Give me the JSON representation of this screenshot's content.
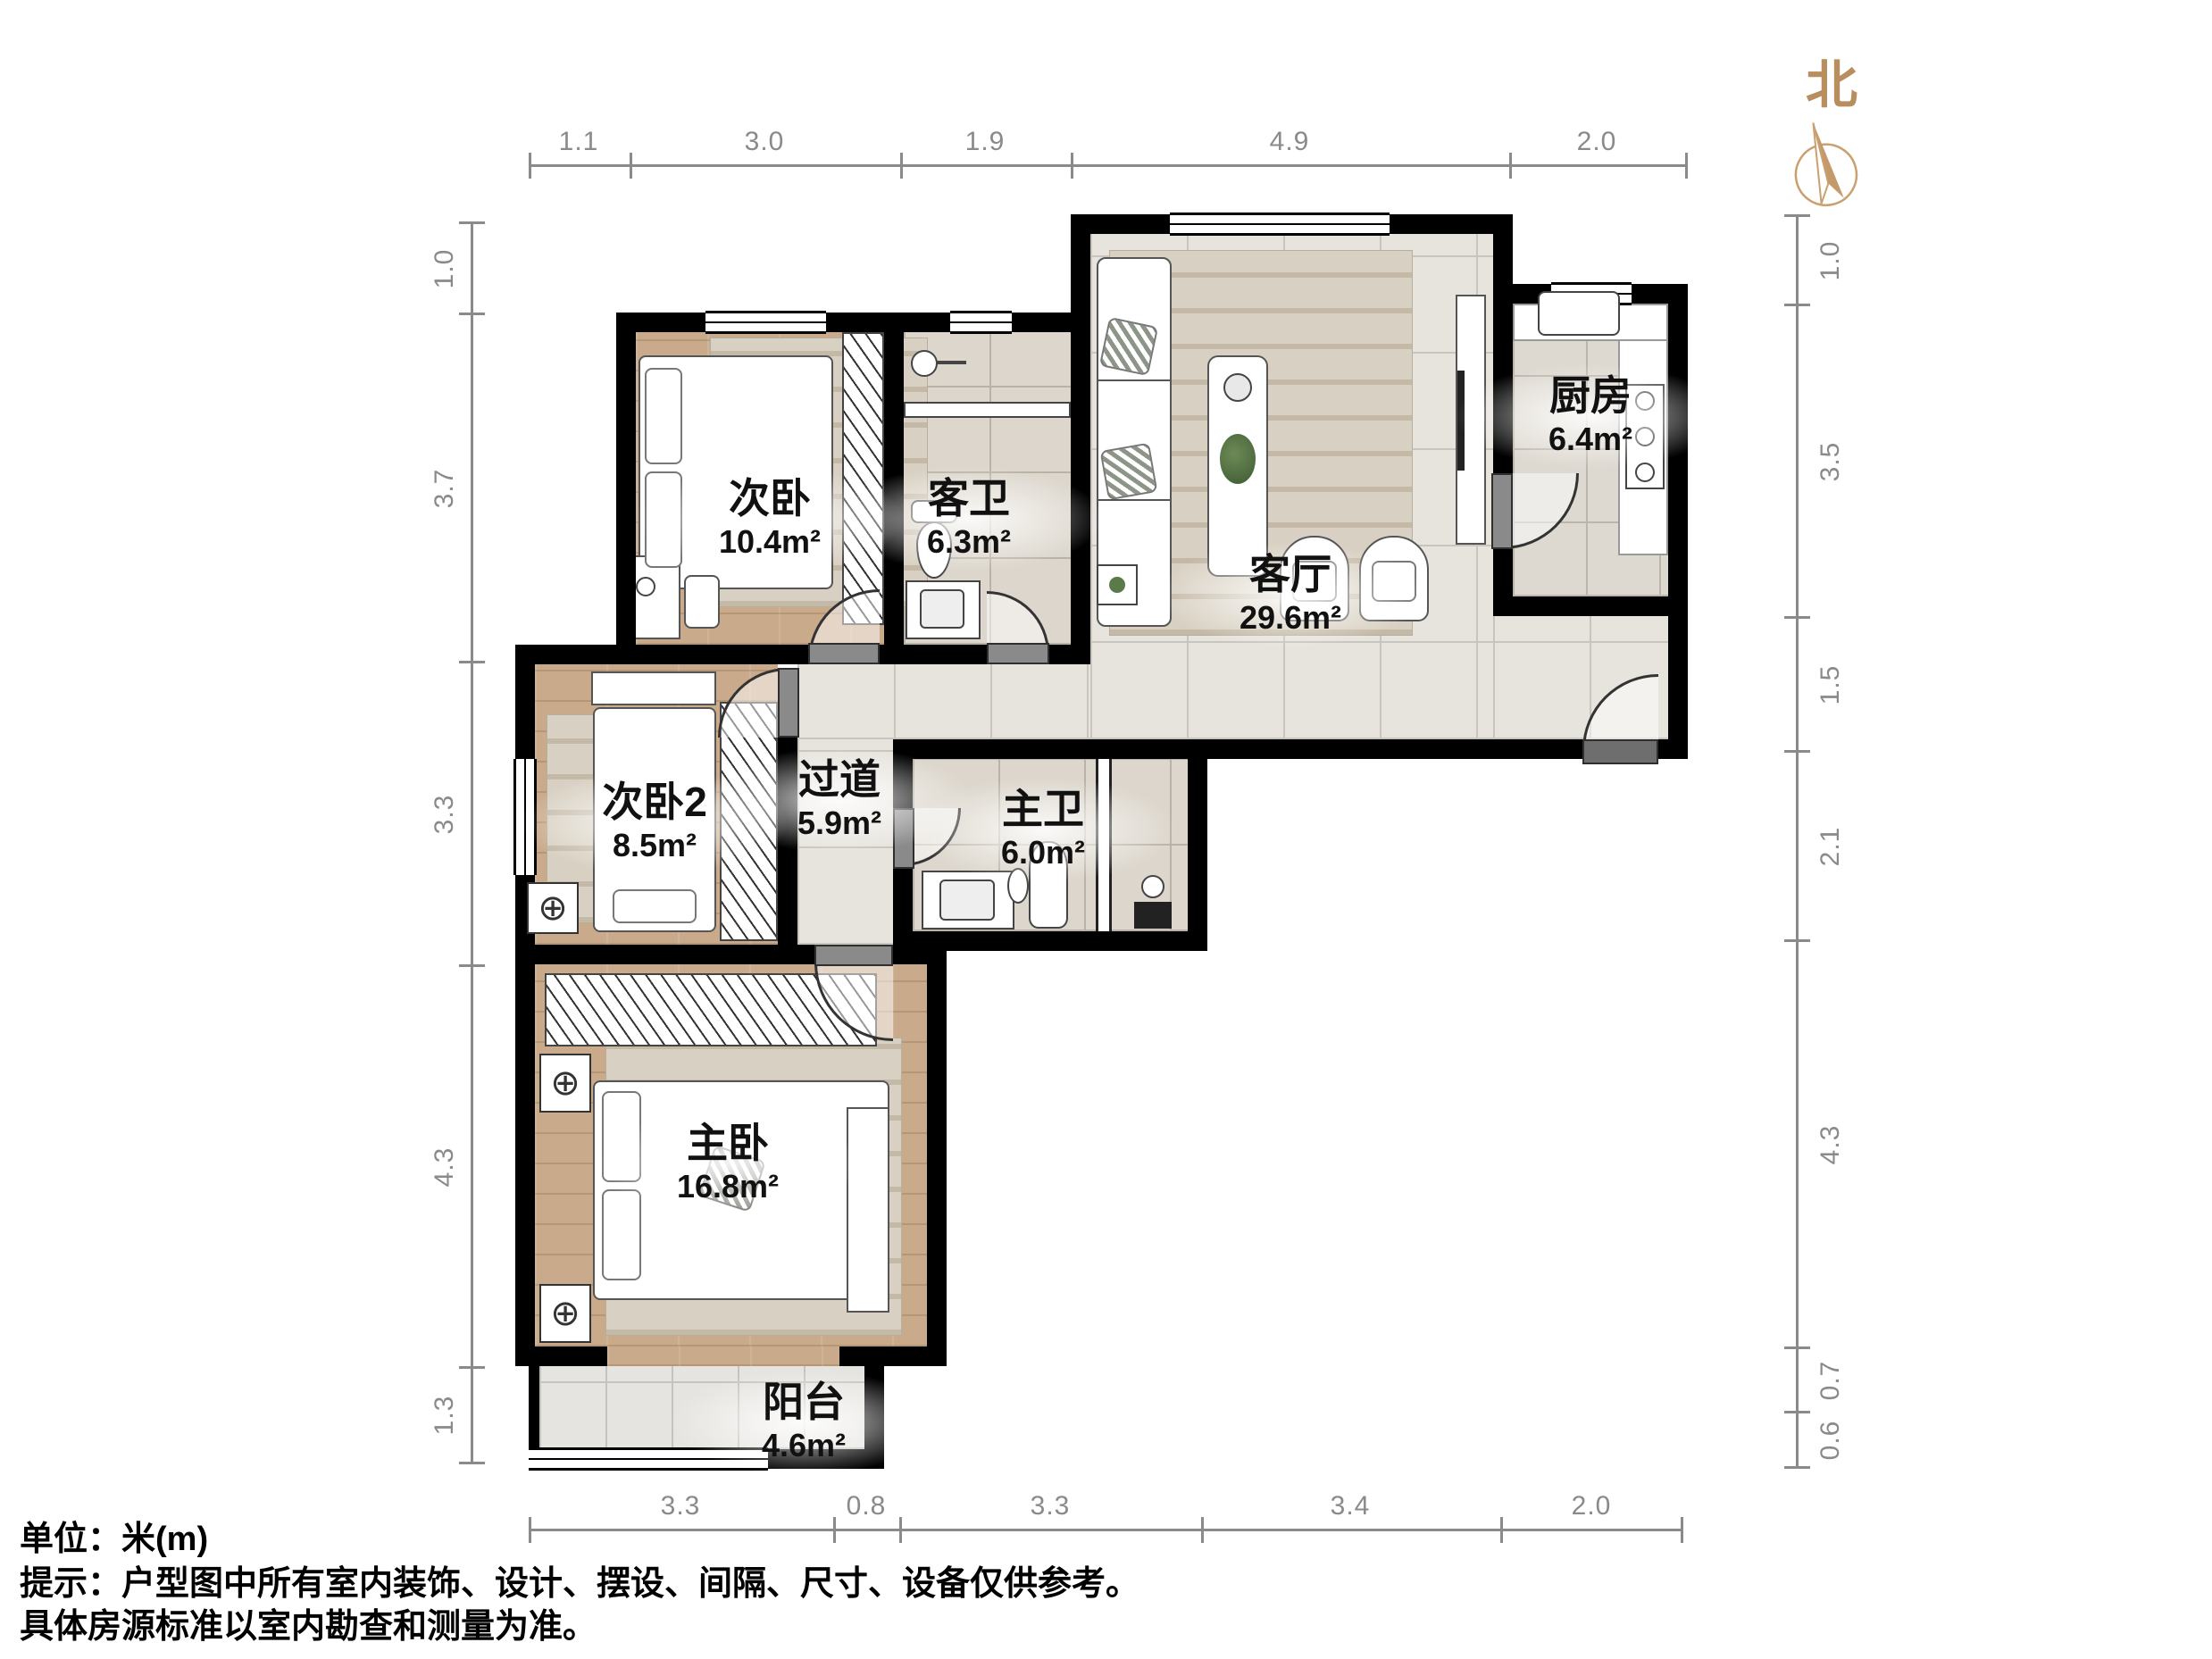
{
  "compass": {
    "label": "北"
  },
  "rooms": [
    {
      "id": "ciwo",
      "name": "次卧",
      "area": "10.4m²"
    },
    {
      "id": "kewei",
      "name": "客卫",
      "area": "6.3m²"
    },
    {
      "id": "keting",
      "name": "客厅",
      "area": "29.6m²"
    },
    {
      "id": "chufang",
      "name": "厨房",
      "area": "6.4m²"
    },
    {
      "id": "ciwo2",
      "name": "次卧2",
      "area": "8.5m²"
    },
    {
      "id": "guodao",
      "name": "过道",
      "area": "5.9m²"
    },
    {
      "id": "zhuwei",
      "name": "主卫",
      "area": "6.0m²"
    },
    {
      "id": "zhuwo",
      "name": "主卧",
      "area": "16.8m²"
    },
    {
      "id": "yangtai",
      "name": "阳台",
      "area": "4.6m²"
    }
  ],
  "dimensions": {
    "top": [
      "1.1",
      "3.0",
      "1.9",
      "4.9",
      "2.0"
    ],
    "bottom": [
      "3.3",
      "0.8",
      "3.3",
      "3.4",
      "2.0"
    ],
    "left": [
      "1.0",
      "3.7",
      "3.3",
      "4.3",
      "1.3"
    ],
    "right": [
      "1.0",
      "3.5",
      "1.5",
      "2.1",
      "4.3",
      "0.7",
      "0.6"
    ]
  },
  "notes": {
    "unit": "单位：米(m)",
    "tip": "提示：户型图中所有室内装饰、设计、摆设、间隔、尺寸、设备仅供参考。",
    "tip2": "具体房源标准以室内勘查和测量为准。"
  }
}
